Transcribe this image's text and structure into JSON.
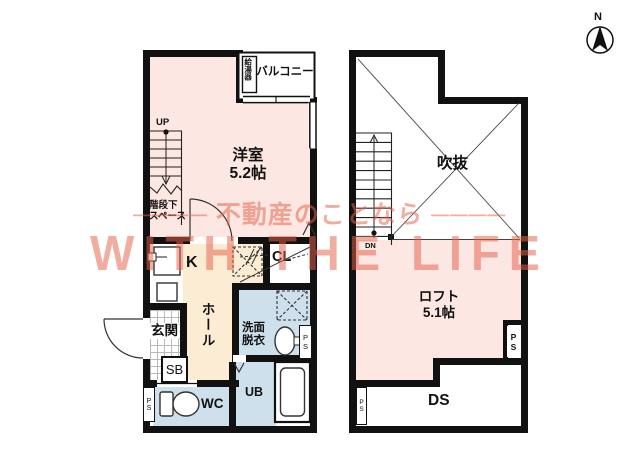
{
  "watermark": {
    "line1": "──── 不動産のことなら ────",
    "line2": "WITH THE LIFE"
  },
  "compass": {
    "north": "N"
  },
  "floor1": {
    "balcony": "バルコニー",
    "water_heater": "給湯器",
    "room_name": "洋室",
    "room_size": "5.2帖",
    "stairs_up": "UP",
    "under_stairs_line1": "階段下",
    "under_stairs_line2": "スペース",
    "kitchen": "K",
    "hall": "ホール",
    "entrance": "玄関",
    "shoe_box": "SB",
    "closet": "CL",
    "washroom_line1": "洗面",
    "washroom_line2": "脱衣",
    "toilet": "WC",
    "unit_bath": "UB",
    "pipe_space_left": "PS",
    "pipe_space_right": "PS"
  },
  "floor2": {
    "void": "吹抜",
    "stairs_down": "DN",
    "loft_name": "ロフト",
    "loft_size": "5.1帖",
    "duct_space": "DS",
    "pipe_space_right": "PS",
    "pipe_space_left": "PS"
  },
  "colors": {
    "room_pink": "#fce7e2",
    "kitchen_cream": "#fcecd4",
    "wet_area_blue": "#cfe0ed",
    "wall_black": "#111111",
    "watermark_salmon": "#e7614a"
  }
}
